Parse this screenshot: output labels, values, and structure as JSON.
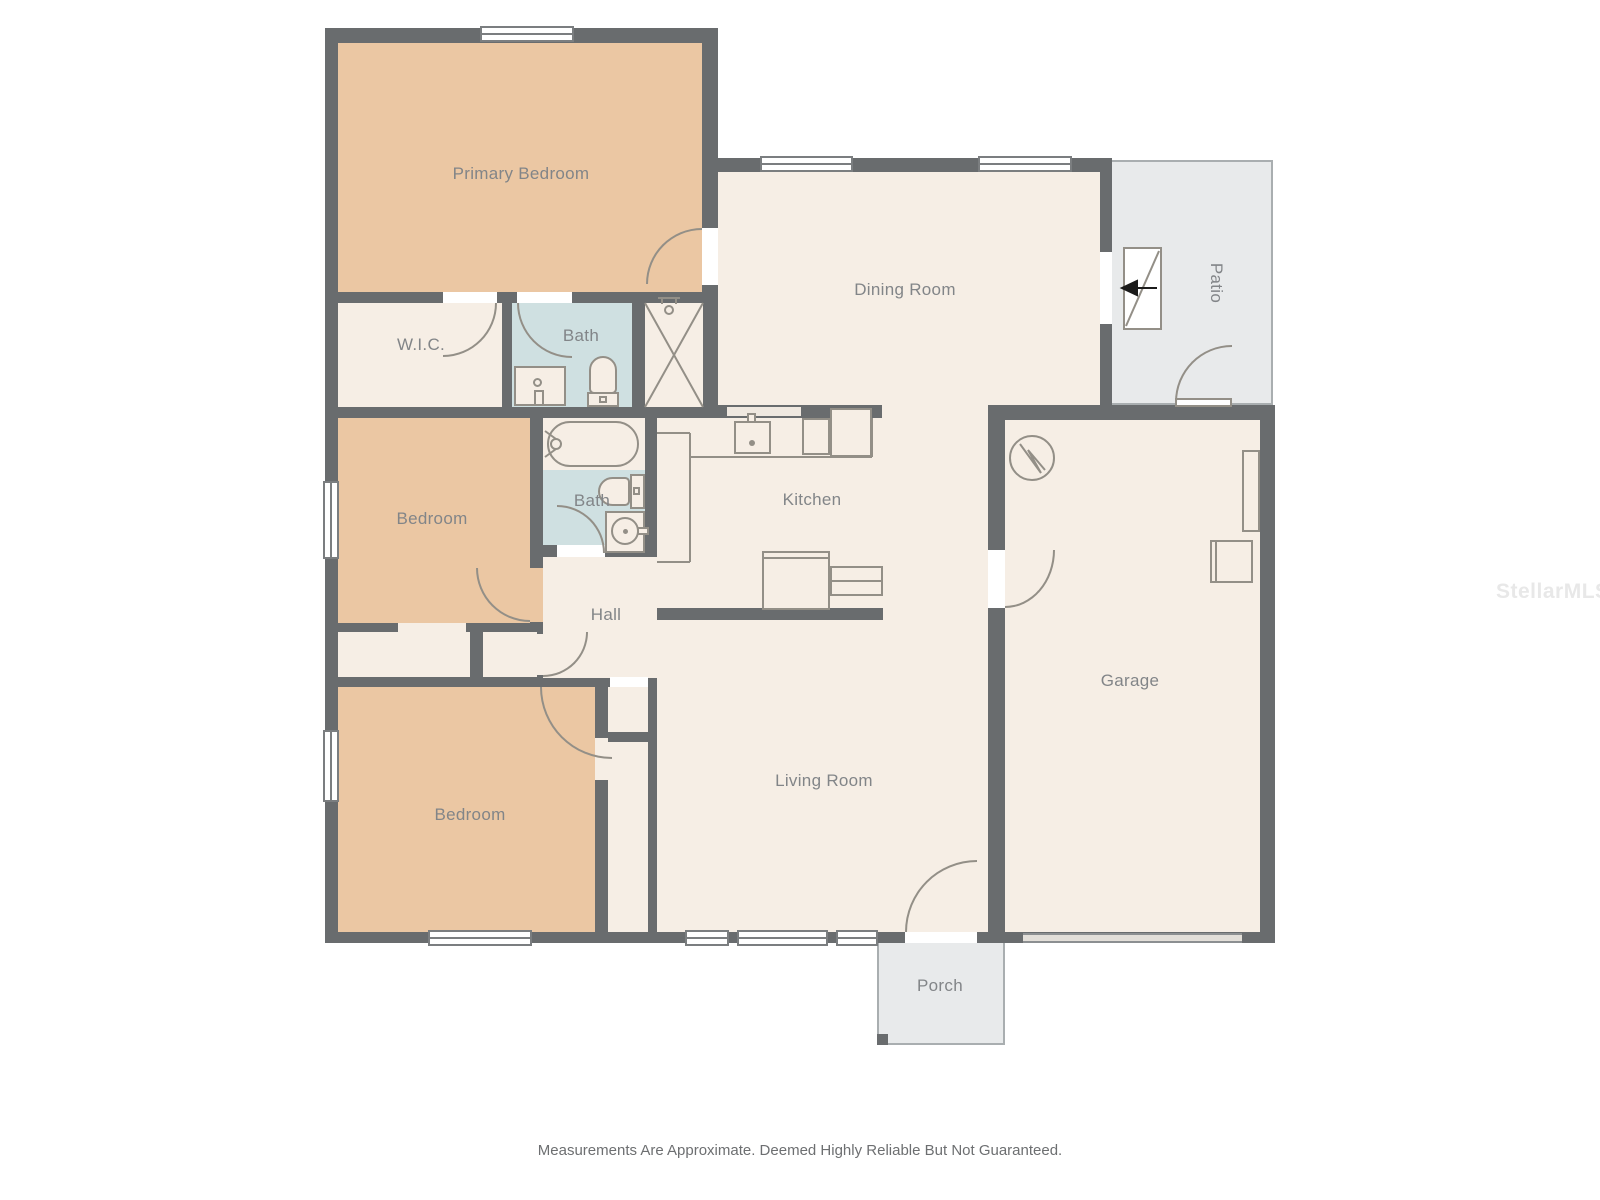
{
  "floor_plan": {
    "rooms": [
      {
        "id": "primary_bedroom",
        "label": "Primary Bedroom"
      },
      {
        "id": "wic",
        "label": "W.I.C."
      },
      {
        "id": "bath_primary",
        "label": "Bath"
      },
      {
        "id": "dining_room",
        "label": "Dining Room"
      },
      {
        "id": "patio",
        "label": "Patio"
      },
      {
        "id": "bedroom_middle",
        "label": "Bedroom"
      },
      {
        "id": "bath_hall",
        "label": "Bath"
      },
      {
        "id": "kitchen",
        "label": "Kitchen"
      },
      {
        "id": "hall",
        "label": "Hall"
      },
      {
        "id": "bedroom_front",
        "label": "Bedroom"
      },
      {
        "id": "living_room",
        "label": "Living Room"
      },
      {
        "id": "garage",
        "label": "Garage"
      },
      {
        "id": "porch",
        "label": "Porch"
      }
    ],
    "fixtures": [
      "shower",
      "toilet",
      "vanity-sink",
      "bathtub",
      "kitchen-sink",
      "kitchen-counter",
      "kitchen-island",
      "water-heater",
      "entry-direction-arrow",
      "garage-door",
      "porch-pillar"
    ],
    "colors": {
      "wall": "#696c6e",
      "bedroom_fill": "#ebc7a3",
      "room_fill": "#f6eee5",
      "bath_fill": "#cfe0e1",
      "outdoor_fill": "#e8eaeb",
      "fixture_line": "#938f87",
      "label_text": "#828588"
    },
    "watermark": "StellarMLS",
    "disclaimer": "Measurements Are Approximate. Deemed Highly Reliable But Not Guaranteed."
  }
}
